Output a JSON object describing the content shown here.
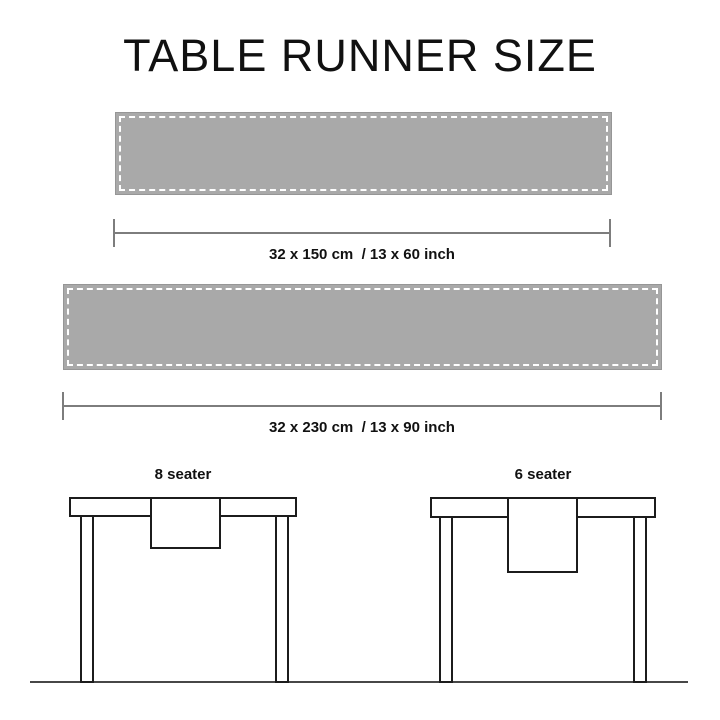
{
  "title": "TABLE RUNNER SIZE",
  "runners": [
    {
      "name": "runner-150",
      "size_label": "32 x 150 cm  / 13 x 60 inch"
    },
    {
      "name": "runner-230",
      "size_label": "32 x 230 cm  / 13 x 90 inch"
    }
  ],
  "tables": [
    {
      "name": "table-8-seater",
      "label": "8 seater"
    },
    {
      "name": "table-6-seater",
      "label": "6 seater"
    }
  ],
  "colors": {
    "background": "#ffffff",
    "runner_fill": "#a9a9a9",
    "runner_border": "#969696",
    "stitch": "#ffffff",
    "dimension_line": "#7d7d7d",
    "text": "#111111",
    "table_outline": "#1c1c1c",
    "ground_line": "#474747"
  }
}
